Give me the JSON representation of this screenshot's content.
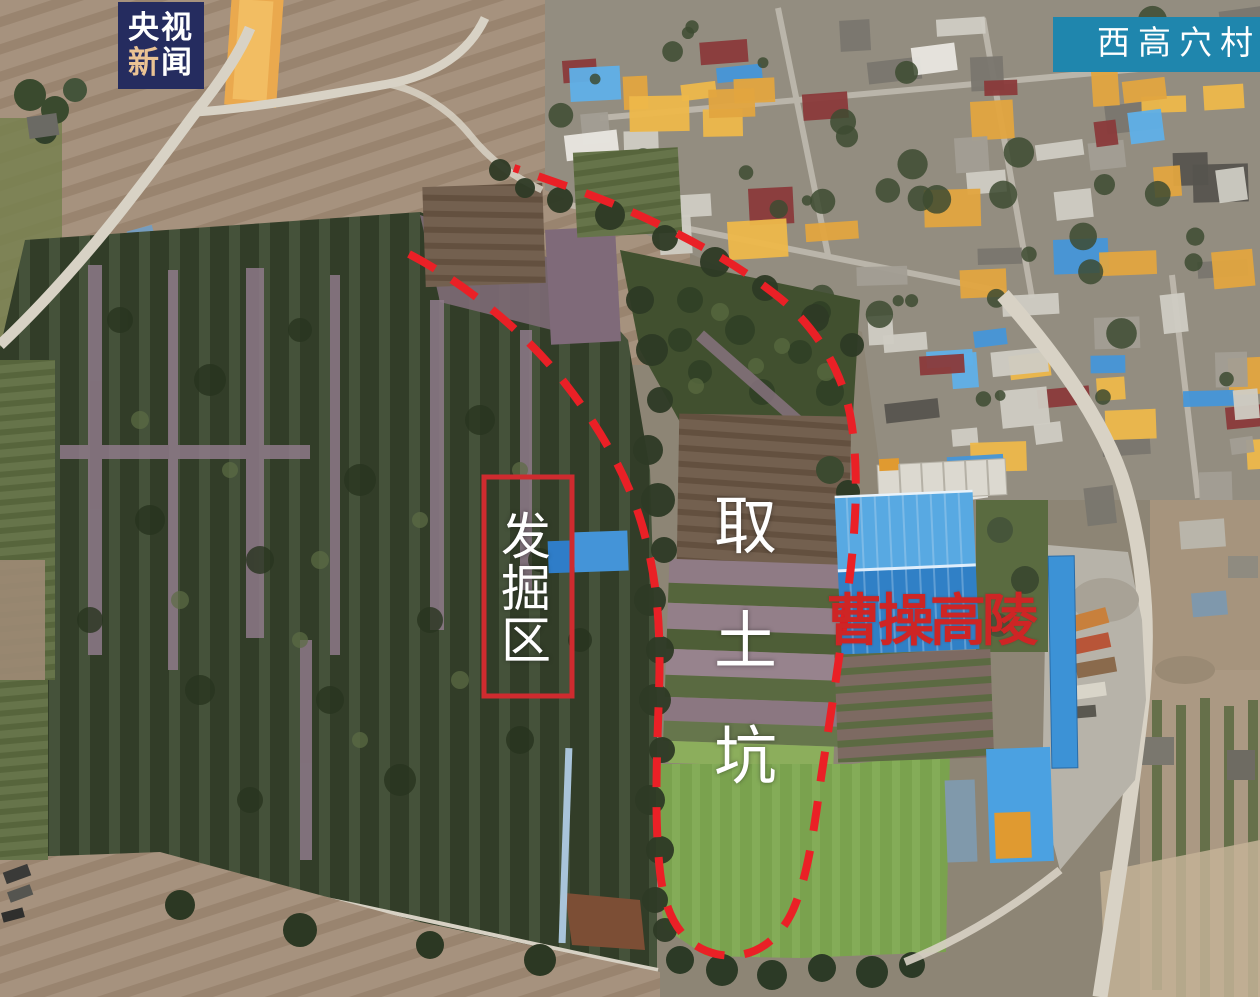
{
  "branding": {
    "line1": "央视",
    "line2_first": "新",
    "line2_second": "闻",
    "box_color": "#252c5f",
    "line1_color": "#ffffff",
    "line2_first_color": "#eac394",
    "line2_second_color": "#ffffff"
  },
  "location_badge": {
    "label": "西高穴村",
    "box_color": "#1f86ad",
    "text_color": "#ffffff"
  },
  "labels": {
    "excavation_area": {
      "text": "发掘区",
      "chars": [
        "发",
        "掘",
        "区"
      ],
      "text_color": "#ffffff",
      "box_color": "#cf2b2f"
    },
    "soil_pit": {
      "text": "取土坑",
      "chars": [
        "取",
        "土",
        "坑"
      ],
      "text_color": "#ffffff"
    },
    "mausoleum": {
      "text": "曹操高陵",
      "text_color": "#ce2525"
    },
    "boundary": {
      "color": "#ea2026",
      "style": "dashed"
    }
  }
}
